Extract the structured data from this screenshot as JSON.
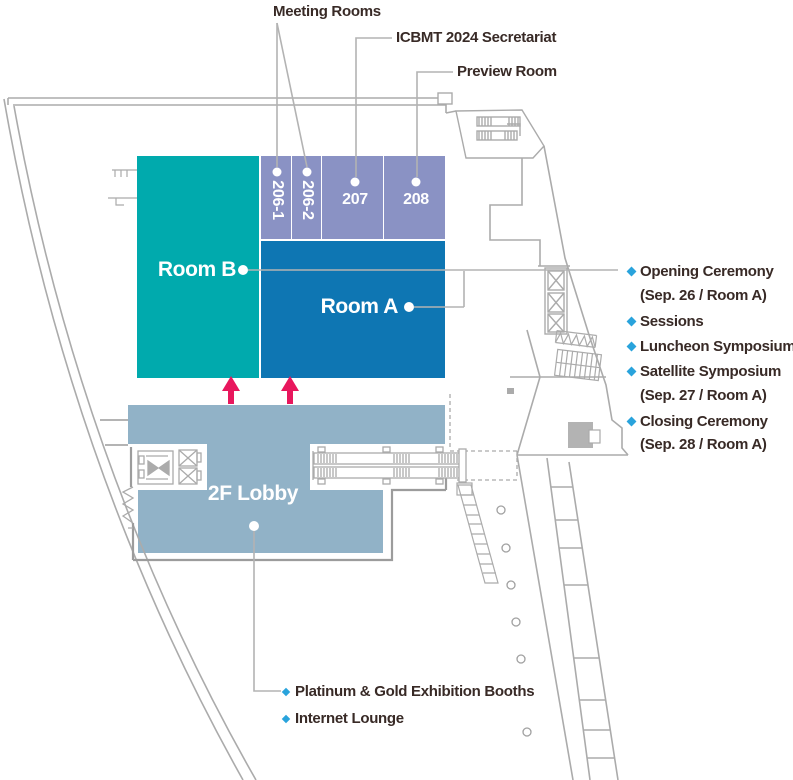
{
  "palette": {
    "room_b_teal": "#00AAAD",
    "room_a_blue": "#0E76B3",
    "meeting_lavender": "#8A92C4",
    "lobby_blue": "#91B2C7",
    "arrow_pink": "#E8175D",
    "bullet_cyan": "#29A3DC",
    "wall_gray": "#ABABAB",
    "text_dark": "#382A26"
  },
  "callout_labels": {
    "meeting_rooms": "Meeting Rooms",
    "secretariat": "ICBMT 2024 Secretariat",
    "preview_room": "Preview Room"
  },
  "rooms": {
    "room_b": "Room B",
    "room_a": "Room A",
    "lobby": "2F Lobby",
    "meeting": [
      "206-1",
      "206-2",
      "207",
      "208"
    ]
  },
  "room_a_events": [
    "Opening Ceremony",
    "(Sep. 26 / Room A)",
    "Sessions",
    "Luncheon Symposiums",
    "Satellite Symposium",
    "(Sep. 27 / Room A)",
    "Closing Ceremony",
    "(Sep. 28 / Room A)"
  ],
  "lobby_features": [
    "Platinum & Gold Exhibition Booths",
    "Internet Lounge"
  ]
}
